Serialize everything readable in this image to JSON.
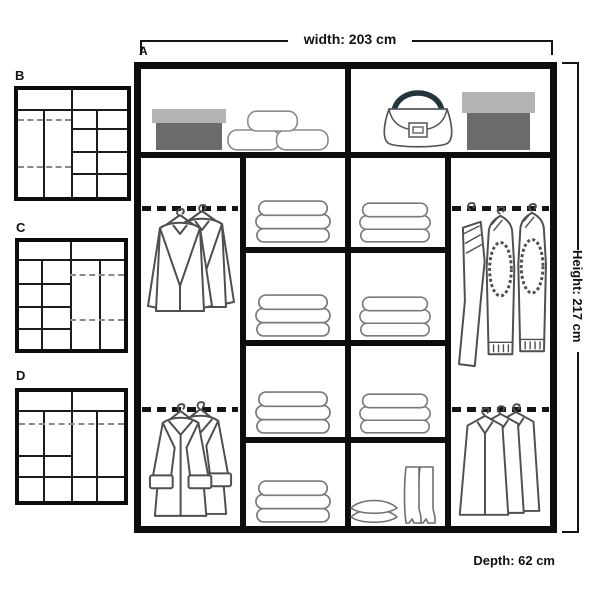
{
  "dimensions": {
    "width_label": "width: 203 cm",
    "height_label": "Height: 217 cm",
    "depth_label": "Depth: 62 cm"
  },
  "main_unit": {
    "label": "A",
    "top_shelf": {
      "left_cell_items": [
        "shoe-box",
        "cushion-stack"
      ],
      "right_cell_items": [
        "handbag",
        "storage-box"
      ]
    },
    "columns": [
      {
        "type": "double-hanging",
        "items": [
          "jackets-on-hangers",
          "coats-on-hangers"
        ]
      },
      {
        "type": "shelves",
        "items": [
          "folded-clothes",
          "folded-clothes",
          "folded-clothes",
          "folded-clothes"
        ]
      },
      {
        "type": "shelves",
        "items": [
          "folded-clothes",
          "folded-clothes",
          "folded-clothes",
          "pillows-and-boots"
        ]
      },
      {
        "type": "double-hanging",
        "items": [
          "sweaters-on-hangers",
          "shirts-on-hangers"
        ]
      }
    ]
  },
  "variants": [
    {
      "label": "B",
      "layout": "double-hang left, shelf grid right"
    },
    {
      "label": "C",
      "layout": "shelf grid left, double-hang right"
    },
    {
      "label": "D",
      "layout": "full-width hanging rail with lower shelves"
    }
  ],
  "colors": {
    "structure": "#0d0d0d",
    "drawing_outline": "#4f4f4f",
    "box_lid": "#b3b3b3",
    "box_body": "#6b6b6b",
    "bag_handle": "#24343a"
  }
}
